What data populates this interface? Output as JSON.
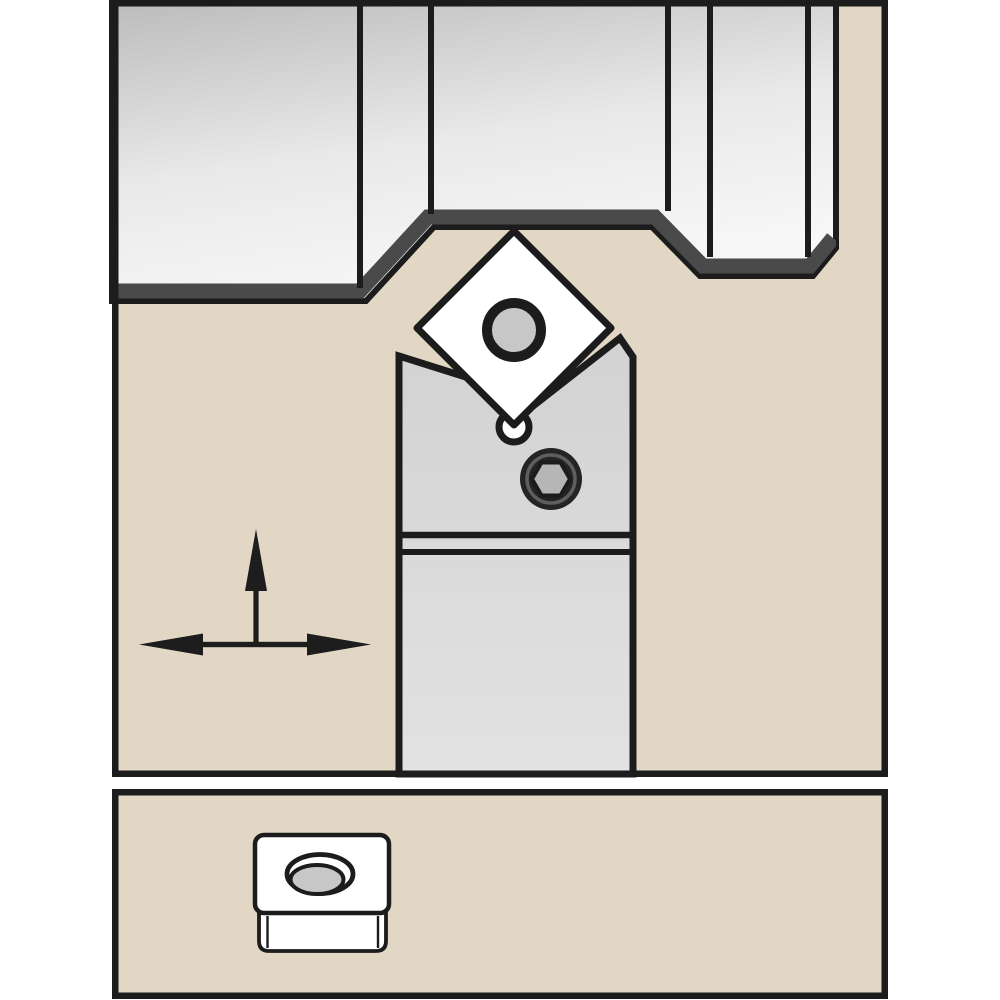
{
  "meta": {
    "title": "Turning tool holder with insert cutting a stepped workpiece - technical catalog illustration",
    "canvas": {
      "width": 1000,
      "height": 1000
    }
  },
  "colors": {
    "page_background": "#ffffff",
    "panel_background": "#e2d7c4",
    "outline": "#1c1c1c",
    "chamfer_band": "#4a4a4a",
    "workpiece_gradient_start": "#bcbcbc",
    "workpiece_gradient_mid": "#e9e9e9",
    "workpiece_gradient_end": "#f7f7f7",
    "holder_gradient_start": "#d2d2d2",
    "holder_gradient_end": "#e2e2e2",
    "insert_fill": "#ffffff",
    "insert_hole_fill": "#c7c7c7",
    "screw_body": "#242424",
    "screw_highlight": "#5e5e5e",
    "screw_hex_fill": "#b6b6b6",
    "arrow_color": "#1d1d1d"
  },
  "main_panel": {
    "components": [
      "workpiece",
      "tool-holder",
      "diamond-insert",
      "insert-center-hole",
      "insert-relief-hole",
      "clamp-screw-hex",
      "feed-direction-arrows"
    ]
  },
  "bottom_panel": {
    "components": [
      "square-insert",
      "countersunk-oval-hole"
    ]
  }
}
